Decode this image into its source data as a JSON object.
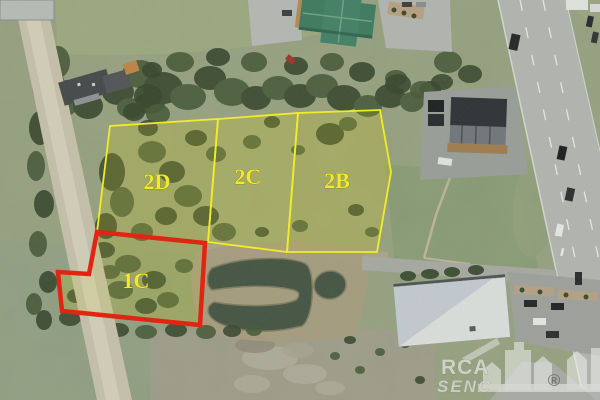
{
  "lots": [
    {
      "label": "2D",
      "outline_color": "#f0ec2a"
    },
    {
      "label": "2C",
      "outline_color": "#f0ec2a"
    },
    {
      "label": "2B",
      "outline_color": "#f0ec2a"
    },
    {
      "label": "1C",
      "outline_color": "#e02512"
    }
  ],
  "colors": {
    "label_yellow": "#f2e92f",
    "outline_yellow": "#f0ec2a",
    "outline_red": "#e02512"
  },
  "watermark": {
    "brand": "RCA",
    "sub": "SENC",
    "registered": "®"
  }
}
